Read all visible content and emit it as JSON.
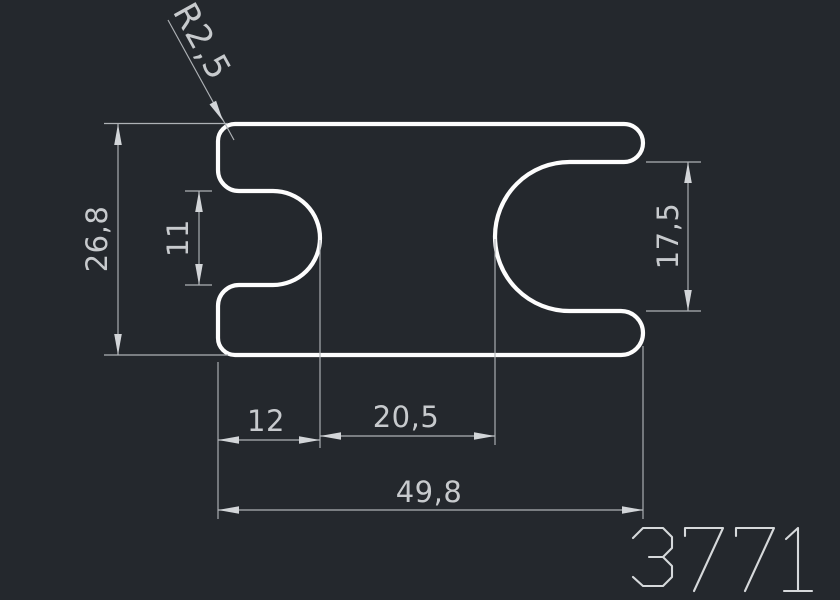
{
  "window": {
    "background_color": "#24282d"
  },
  "drawing": {
    "part_number": "3771",
    "outline_color": "#fdfdfd",
    "dimension_line_color": "#aeb2b6",
    "dimension_text_color": "#c7cacd",
    "labels": {
      "corner_radius": "R2,5",
      "overall_height": "26,8",
      "left_slot_height": "11",
      "right_slot_height": "17,5",
      "left_slot_depth": "12",
      "center_span": "20,5",
      "overall_width": "49,8"
    }
  }
}
